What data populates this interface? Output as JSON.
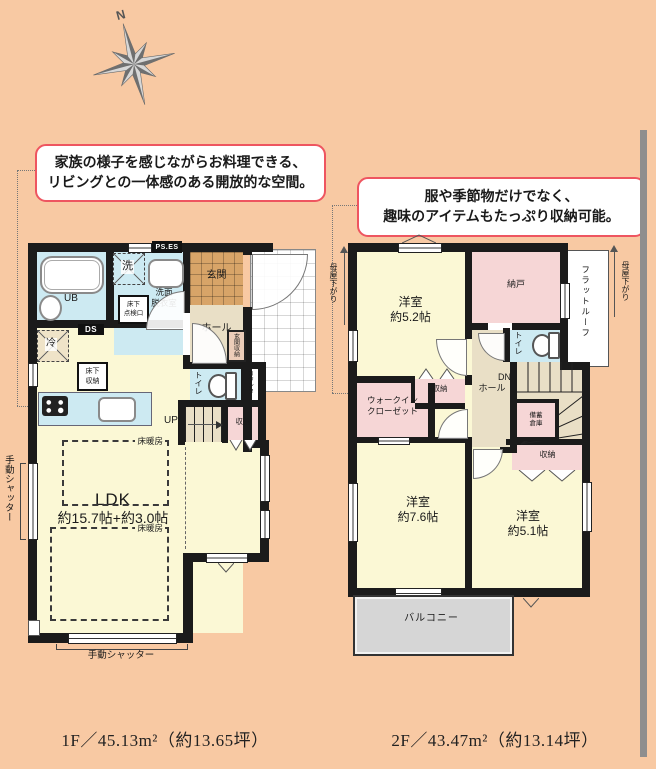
{
  "compass": {
    "north": "N"
  },
  "callouts": {
    "kitchen": {
      "line1": "家族の様子を感じながらお料理できる、",
      "line2": "リビングとの一体感のある開放的な空間。"
    },
    "storage": {
      "line1": "服や季節物だけでなく、",
      "line2": "趣味のアイテムもたっぷり収納可能。"
    }
  },
  "floor1": {
    "labels": {
      "ub": "UB",
      "washer": "洗",
      "ps_es": "PS.ES",
      "senmen": "洗面\n脱衣室",
      "tenken": "床下\n点検口",
      "ds": "DS",
      "fridge": "冷",
      "yukashita": "床下\n収納",
      "genkan": "玄関",
      "hall": "ホール",
      "genkan_shuno": "玄関収納",
      "toilet": "トイレ",
      "counter": "カウンター",
      "up": "UP",
      "shuno": "収納",
      "ldk": "LDK",
      "ldk_size": "約15.7帖+約3.0帖",
      "yukadanbo": "床暖房",
      "shutter": "手動シャッター"
    },
    "area": "1F／45.13m²（約13.65坪）"
  },
  "floor2": {
    "labels": {
      "room52": "洋室\n約5.2帖",
      "nando": "納戸",
      "flat_roof": "フラットルーフ",
      "moya": "母屋下がり",
      "toilet": "トイレ",
      "dn": "DN",
      "hall": "ホール",
      "shuno_a": "収納",
      "wic": "ウォークイン\nクローゼット",
      "bichiku": "備蓄\n倉庫",
      "shuno_b": "収納",
      "room76": "洋室\n約7.6帖",
      "room51": "洋室\n約5.1帖",
      "balcony": "バルコニー"
    },
    "area": "2F／43.47m²（約13.14坪）"
  }
}
